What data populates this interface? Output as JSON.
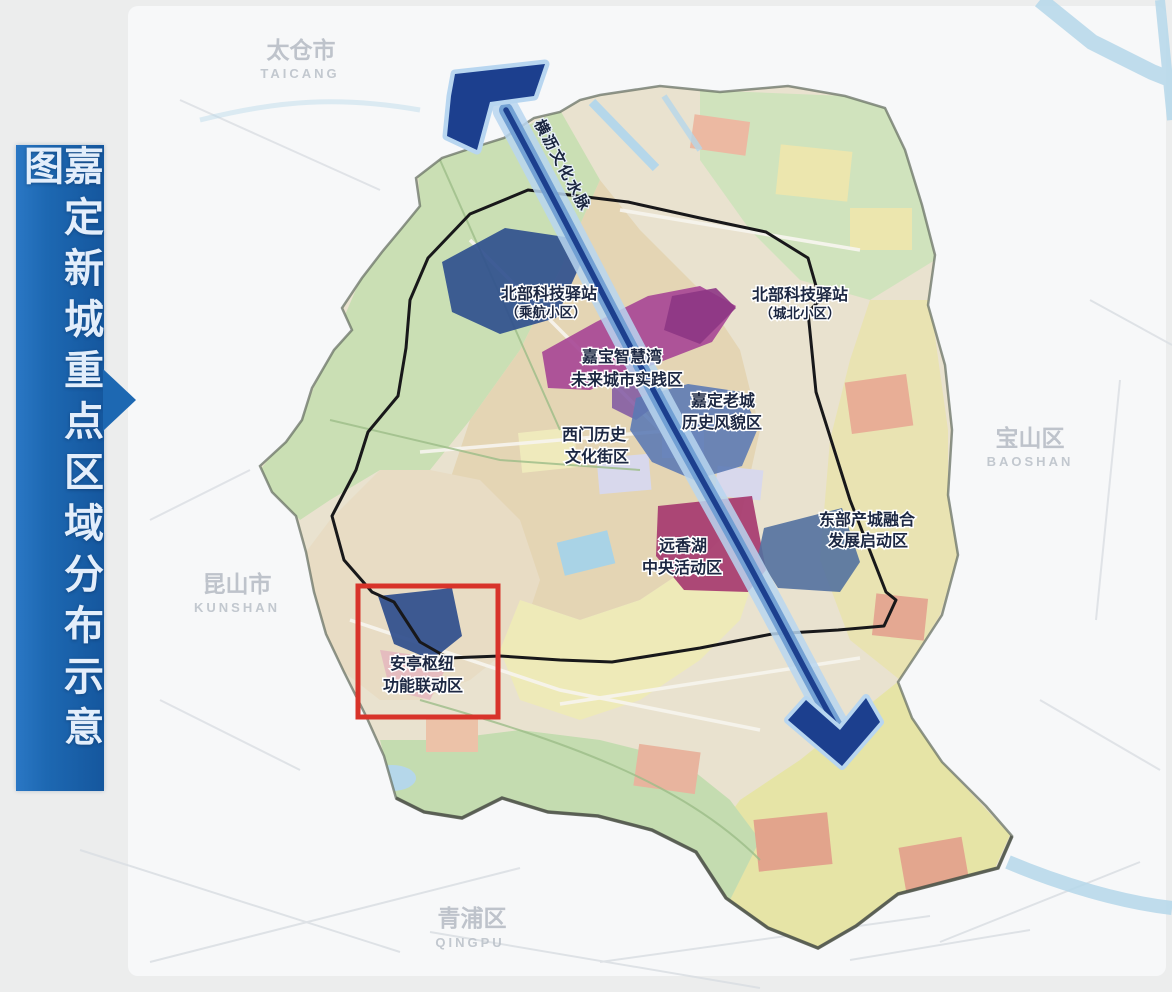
{
  "banner": {
    "title": "嘉定新城重点区域分布示意图"
  },
  "map": {
    "neighbors": [
      {
        "zh": "太仓市",
        "en": "TAICANG"
      },
      {
        "zh": "宝山区",
        "en": "BAOSHAN"
      },
      {
        "zh": "昆山市",
        "en": "KUNSHAN"
      },
      {
        "zh": "青浦区",
        "en": "QINGPU"
      }
    ],
    "corridor": {
      "label": "横沥文化水脉"
    },
    "zones": [
      {
        "line1": "北部科技驿站",
        "line2": "（乘航小区）"
      },
      {
        "line1": "北部科技驿站",
        "line2": "（城北小区）"
      },
      {
        "line1": "嘉宝智慧湾",
        "line2": "未来城市实践区"
      },
      {
        "line1": "嘉定老城",
        "line2": "历史风貌区"
      },
      {
        "line1": "西门历史",
        "line2": "文化街区"
      },
      {
        "line1": "远香湖",
        "line2": "中央活动区"
      },
      {
        "line1": "东部产城融合",
        "line2": "发展启动区"
      },
      {
        "line1": "安亭枢纽",
        "line2": "功能联动区"
      }
    ],
    "colors": {
      "banner_blue": "#1d68b2",
      "corridor_core": "#1c3f8e",
      "corridor_glow": "#b8d6f0",
      "highlight_red": "#d8332a",
      "zone_navy": "#2e4d8c",
      "zone_steel_blue": "#5a79b4",
      "zone_magenta": "#a64595",
      "zone_crimson": "#a63a70",
      "zone_blue": "#53719f"
    }
  }
}
